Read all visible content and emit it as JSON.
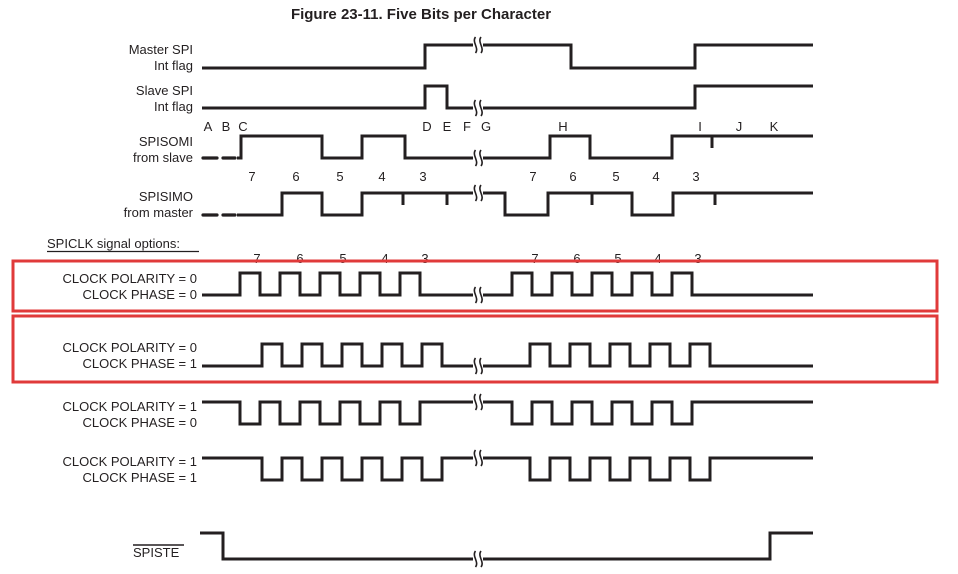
{
  "title": "Figure 23-11. Five Bits per Character",
  "section_label": {
    "text": "SPICLK signal options:",
    "x": 47,
    "y": 248,
    "underline": [
      47,
      199,
      251.5
    ]
  },
  "colors": {
    "line": "#231f20",
    "text": "#231f20",
    "highlight": "#e03a3a",
    "background": "#ffffff"
  },
  "event_letters": {
    "y": 131,
    "items": [
      {
        "t": "A",
        "x": 208
      },
      {
        "t": "B",
        "x": 226
      },
      {
        "t": "C",
        "x": 243
      },
      {
        "t": "D",
        "x": 427
      },
      {
        "t": "E",
        "x": 447
      },
      {
        "t": "F",
        "x": 467
      },
      {
        "t": "G",
        "x": 486
      },
      {
        "t": "H",
        "x": 563
      },
      {
        "t": "I",
        "x": 700
      },
      {
        "t": "J",
        "x": 739
      },
      {
        "t": "K",
        "x": 774
      }
    ]
  },
  "bit_numbers": [
    {
      "y": 181,
      "items": [
        {
          "t": "7",
          "x": 252
        },
        {
          "t": "6",
          "x": 296
        },
        {
          "t": "5",
          "x": 340
        },
        {
          "t": "4",
          "x": 382
        },
        {
          "t": "3",
          "x": 423
        },
        {
          "t": "7",
          "x": 533
        },
        {
          "t": "6",
          "x": 573
        },
        {
          "t": "5",
          "x": 616
        },
        {
          "t": "4",
          "x": 656
        },
        {
          "t": "3",
          "x": 696
        }
      ]
    },
    {
      "y": 263,
      "items": [
        {
          "t": "7",
          "x": 257
        },
        {
          "t": "6",
          "x": 300
        },
        {
          "t": "5",
          "x": 343
        },
        {
          "t": "4",
          "x": 385
        },
        {
          "t": "3",
          "x": 425
        },
        {
          "t": "7",
          "x": 535
        },
        {
          "t": "6",
          "x": 577
        },
        {
          "t": "5",
          "x": 618
        },
        {
          "t": "4",
          "x": 658
        },
        {
          "t": "3",
          "x": 698
        }
      ]
    }
  ],
  "highlight_boxes": [
    {
      "id": "cpol0-cpha0",
      "x": 13,
      "y": 261,
      "w": 924,
      "h": 50
    },
    {
      "id": "cpol0-cpha1",
      "x": 13,
      "y": 316,
      "w": 924,
      "h": 66
    }
  ],
  "signals": [
    {
      "id": "master-spi-int-flag",
      "labels": [
        {
          "text": "Master SPI",
          "x": 193,
          "y": 54
        },
        {
          "text": "Int flag",
          "x": 193,
          "y": 70
        }
      ],
      "initial": "low",
      "low_y": 68,
      "high_y": 45,
      "x_start": 202,
      "x_end": 813,
      "edges": [
        425,
        571,
        695
      ],
      "ticks": [],
      "breaks": [
        478
      ],
      "dashes": []
    },
    {
      "id": "slave-spi-int-flag",
      "labels": [
        {
          "text": "Slave SPI",
          "x": 193,
          "y": 95
        },
        {
          "text": "Int flag",
          "x": 193,
          "y": 111
        }
      ],
      "initial": "low",
      "low_y": 108,
      "high_y": 86,
      "x_start": 202,
      "x_end": 813,
      "edges": [
        425,
        447,
        695
      ],
      "ticks": [],
      "breaks": [
        478
      ],
      "dashes": []
    },
    {
      "id": "spisomi",
      "labels": [
        {
          "text": "SPISOMI",
          "x": 193,
          "y": 146
        },
        {
          "text": "from slave",
          "x": 193,
          "y": 162
        }
      ],
      "initial": "low",
      "low_y": 158,
      "high_y": 136,
      "x_start": 237,
      "x_end": 813,
      "edges": [
        241,
        322,
        362,
        405,
        550,
        590,
        672
      ],
      "ticks": [
        712
      ],
      "breaks": [
        478
      ],
      "dashes": [
        [
          203,
          217
        ],
        [
          223,
          235
        ]
      ]
    },
    {
      "id": "spisimo",
      "labels": [
        {
          "text": "SPISIMO",
          "x": 193,
          "y": 201
        },
        {
          "text": "from master",
          "x": 193,
          "y": 217
        }
      ],
      "initial": "low",
      "low_y": 215,
      "high_y": 193,
      "x_start": 237,
      "x_end": 813,
      "edges": [
        282,
        322,
        362,
        505,
        548,
        632,
        673
      ],
      "ticks": [
        403,
        447,
        592,
        715
      ],
      "breaks": [
        478
      ],
      "dashes": [
        [
          203,
          217
        ],
        [
          223,
          235
        ]
      ]
    },
    {
      "id": "spiclk-cpol0-cpha0",
      "labels": [
        {
          "text": "CLOCK POLARITY = 0",
          "x": 197,
          "y": 283
        },
        {
          "text": "CLOCK PHASE = 0",
          "x": 197,
          "y": 299
        }
      ],
      "initial": "low",
      "low_y": 295,
      "high_y": 273,
      "x_start": 202,
      "x_end": 813,
      "edges": [
        240,
        260,
        280,
        300,
        320,
        340,
        360,
        380,
        400,
        420,
        512,
        532,
        552,
        572,
        592,
        612,
        632,
        652,
        672,
        692
      ],
      "ticks": [],
      "breaks": [
        478
      ],
      "dashes": []
    },
    {
      "id": "spiclk-cpol0-cpha1",
      "labels": [
        {
          "text": "CLOCK POLARITY = 0",
          "x": 197,
          "y": 352
        },
        {
          "text": "CLOCK PHASE = 1",
          "x": 197,
          "y": 368
        }
      ],
      "initial": "low",
      "low_y": 366,
      "high_y": 344,
      "x_start": 202,
      "x_end": 813,
      "edges": [
        262,
        282,
        302,
        322,
        342,
        362,
        382,
        402,
        422,
        442,
        530,
        550,
        570,
        590,
        610,
        630,
        650,
        670,
        690,
        710
      ],
      "ticks": [],
      "breaks": [
        478
      ],
      "dashes": []
    },
    {
      "id": "spiclk-cpol1-cpha0",
      "labels": [
        {
          "text": "CLOCK POLARITY = 1",
          "x": 197,
          "y": 411
        },
        {
          "text": "CLOCK PHASE = 0",
          "x": 197,
          "y": 427
        }
      ],
      "initial": "high",
      "low_y": 424,
      "high_y": 402,
      "x_start": 202,
      "x_end": 813,
      "edges": [
        240,
        260,
        280,
        300,
        320,
        340,
        360,
        380,
        400,
        420,
        512,
        532,
        552,
        572,
        592,
        612,
        632,
        652,
        672,
        692
      ],
      "ticks": [],
      "breaks": [
        478
      ],
      "dashes": []
    },
    {
      "id": "spiclk-cpol1-cpha1",
      "labels": [
        {
          "text": "CLOCK POLARITY = 1",
          "x": 197,
          "y": 466
        },
        {
          "text": "CLOCK PHASE = 1",
          "x": 197,
          "y": 482
        }
      ],
      "initial": "high",
      "low_y": 480,
      "high_y": 458,
      "x_start": 202,
      "x_end": 813,
      "edges": [
        262,
        282,
        302,
        322,
        342,
        362,
        382,
        402,
        422,
        442,
        530,
        550,
        570,
        590,
        610,
        630,
        650,
        670,
        690,
        710
      ],
      "ticks": [],
      "breaks": [
        478
      ],
      "dashes": []
    },
    {
      "id": "spiste",
      "labels": [
        {
          "text": "SPISTE",
          "x": 133,
          "y": 557,
          "anchor": "start",
          "overline": [
            133,
            184,
            545
          ]
        }
      ],
      "initial": "high",
      "low_y": 559,
      "high_y": 533,
      "x_start": 200,
      "x_end": 813,
      "edges": [
        223,
        770
      ],
      "ticks": [],
      "breaks": [
        478
      ],
      "dashes": []
    }
  ]
}
